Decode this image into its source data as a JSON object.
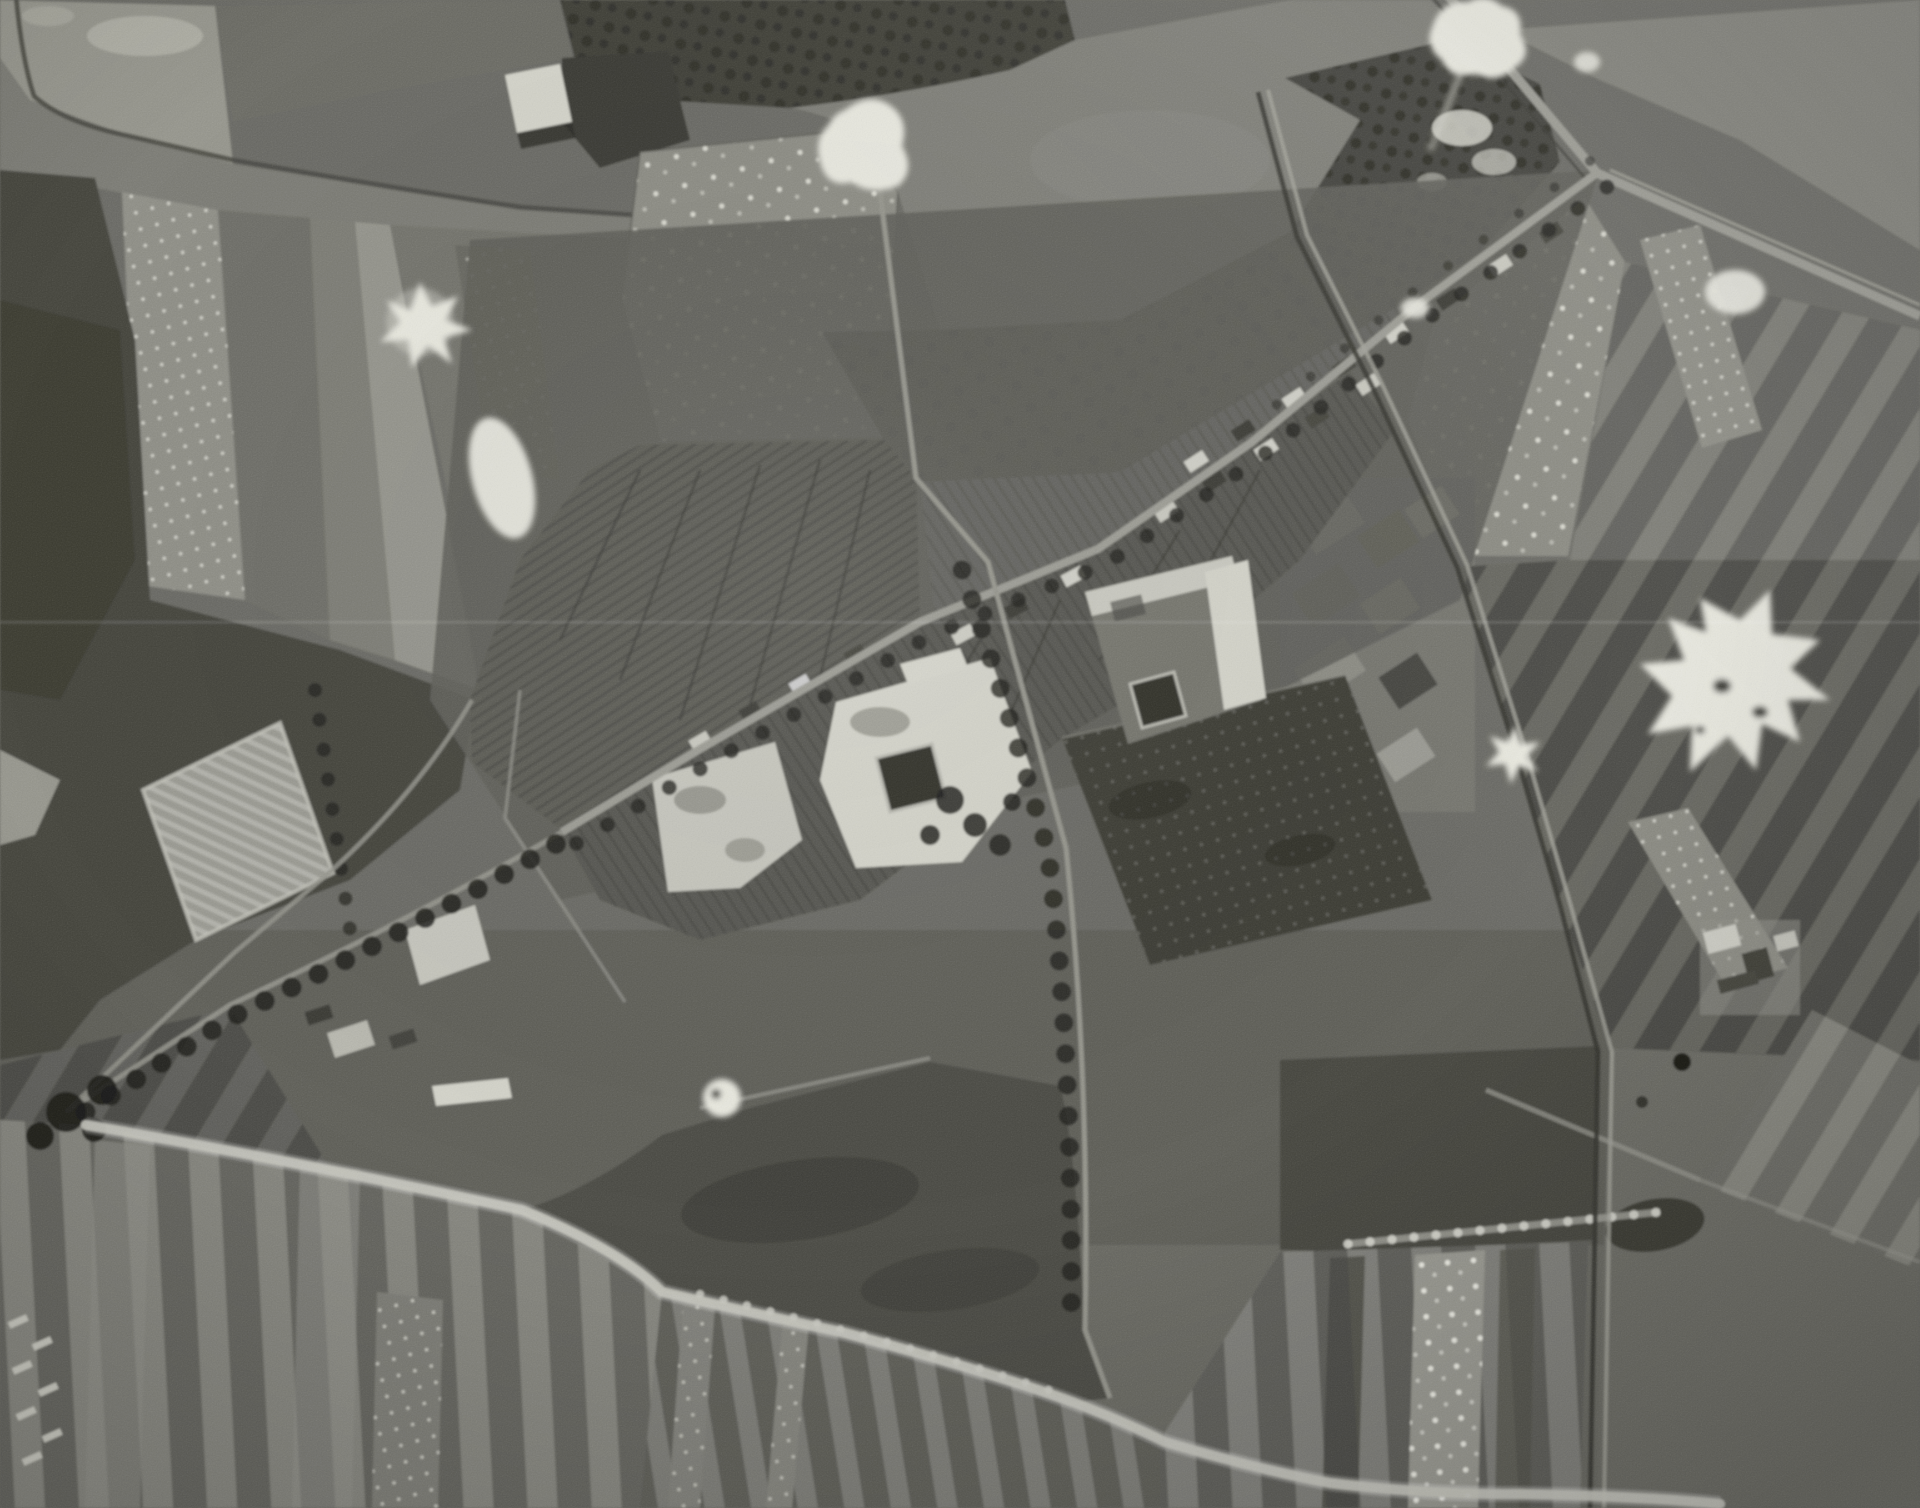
{
  "image": {
    "kind": "black-and-white vertical aerial reconnaissance photograph",
    "scene": "village with walled compounds surrounded by strip fields, orchards, tree-lined roads and bright blast marks",
    "visible_text": ""
  },
  "palette": {
    "base": "#6b6b65",
    "field_light": "#96968d",
    "field_mid": "#7b7b74",
    "field_dark": "#55554f",
    "woods": "#3c3c36",
    "tree_dark": "#22221e",
    "road_light": "#9c9c94",
    "road_bright": "#c9c9c0",
    "building_white": "#d4d4ca",
    "courtyard_dark": "#30302b",
    "white_flash": "#e9e9e0"
  },
  "features": [
    {
      "name": "main-street",
      "desc": "light road running diagonally from upper-right crossroads down through the village centre"
    },
    {
      "name": "highway",
      "desc": "straight light road crossing the upper-right corner"
    },
    {
      "name": "village-compound-west",
      "desc": "bright walled enclosure with dark square courtyard"
    },
    {
      "name": "village-compound-east",
      "desc": "second walled enclosure with dark square courtyard and white range of buildings"
    },
    {
      "name": "orchard-fields",
      "desc": "fields stippled with regular rows of light dots"
    },
    {
      "name": "strip-fields",
      "desc": "narrow alternating light and dark cultivation strips across the bottom of the frame"
    },
    {
      "name": "tree-lined-roads",
      "desc": "rows of dark tree crowns with shadows along roads"
    },
    {
      "name": "blast-marks",
      "desc": "irregular bright white star-shaped patches scattered over fields and roads"
    },
    {
      "name": "pasture",
      "desc": "smooth mid-grey meadow at top centre-right"
    },
    {
      "name": "woods",
      "desc": "dark blocky tree masses at top centre and left edge"
    },
    {
      "name": "allotment-block",
      "desc": "light rectangular plot of striped allotment beds at centre-left"
    },
    {
      "name": "film-scratch",
      "desc": "faint light horizontal scratch line across the frame"
    }
  ]
}
